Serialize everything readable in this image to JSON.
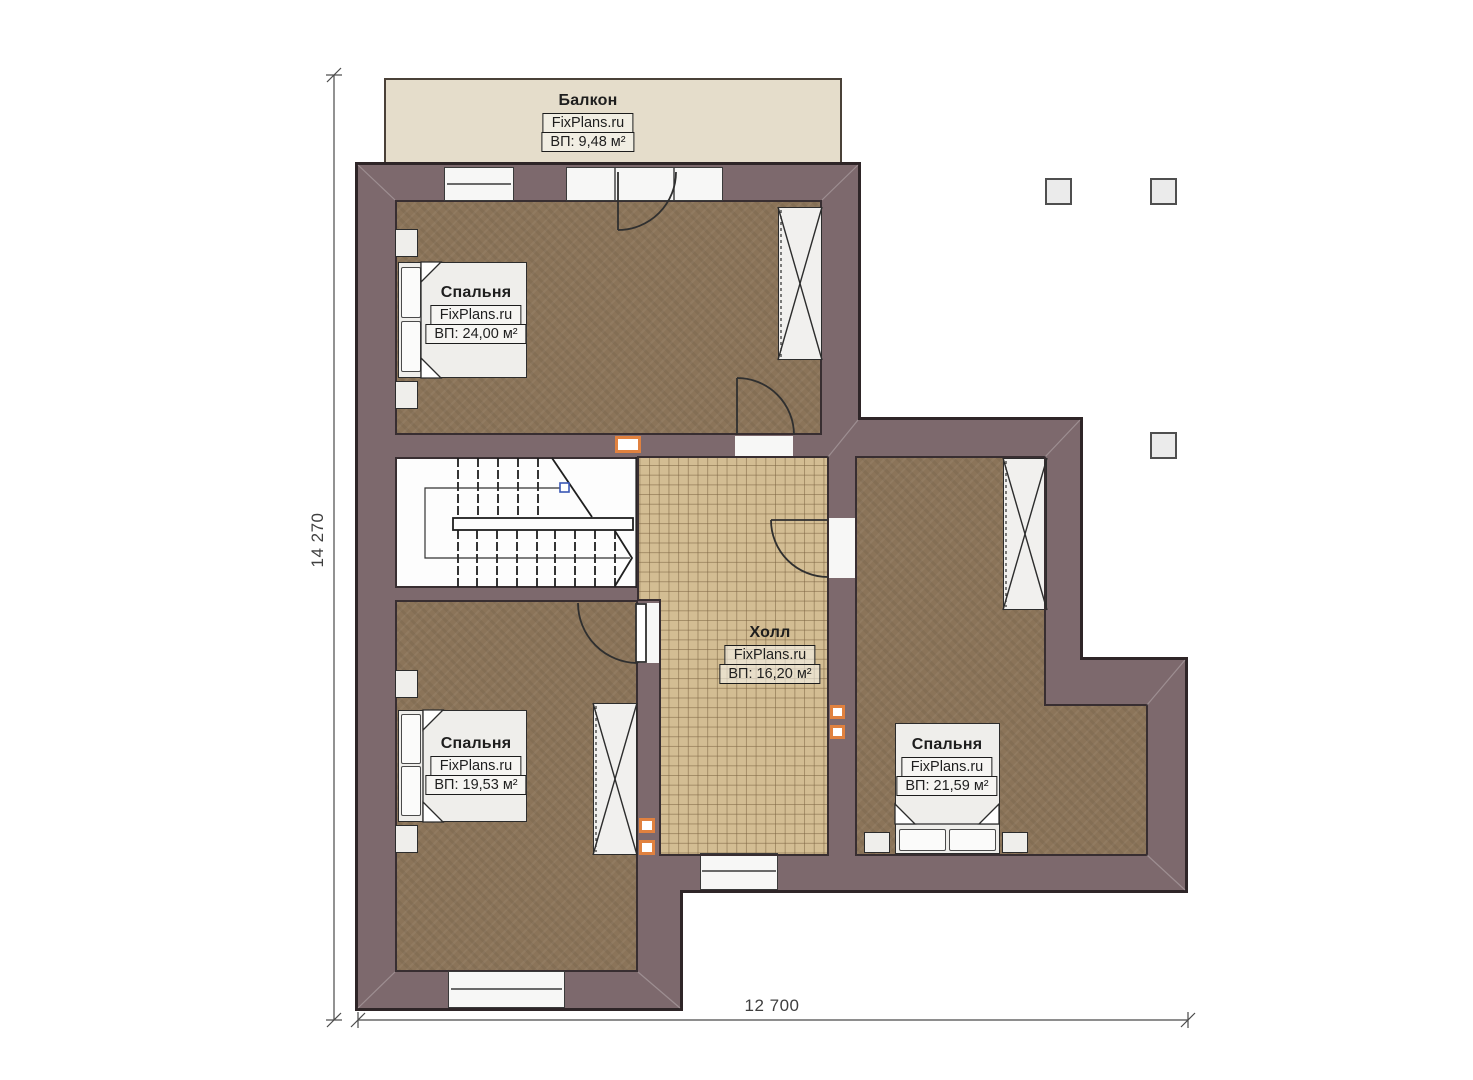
{
  "plan": {
    "brand": "FixPlans.ru",
    "rooms": {
      "balcony": {
        "name": "Балкон",
        "area": "ВП: 9,48 м²"
      },
      "bedroom_top": {
        "name": "Спальня",
        "area": "ВП: 24,00 м²"
      },
      "hall": {
        "name": "Холл",
        "area": "ВП: 16,20 м²"
      },
      "bedroom_bottom": {
        "name": "Спальня",
        "area": "ВП: 19,53 м²"
      },
      "bedroom_right": {
        "name": "Спальня",
        "area": "ВП: 21,59 м²"
      }
    },
    "dimensions": {
      "vertical": "14 270",
      "horizontal": "12 700"
    },
    "colors": {
      "wall": "#7d696d",
      "wall_outline": "#2e2527",
      "floor_carpet": "#8b7459",
      "floor_tile": "#d3bd93",
      "balcony": "#e5ddcb",
      "accent_orange": "#e0813f",
      "stair_node_blue": "#3a57b5"
    }
  }
}
